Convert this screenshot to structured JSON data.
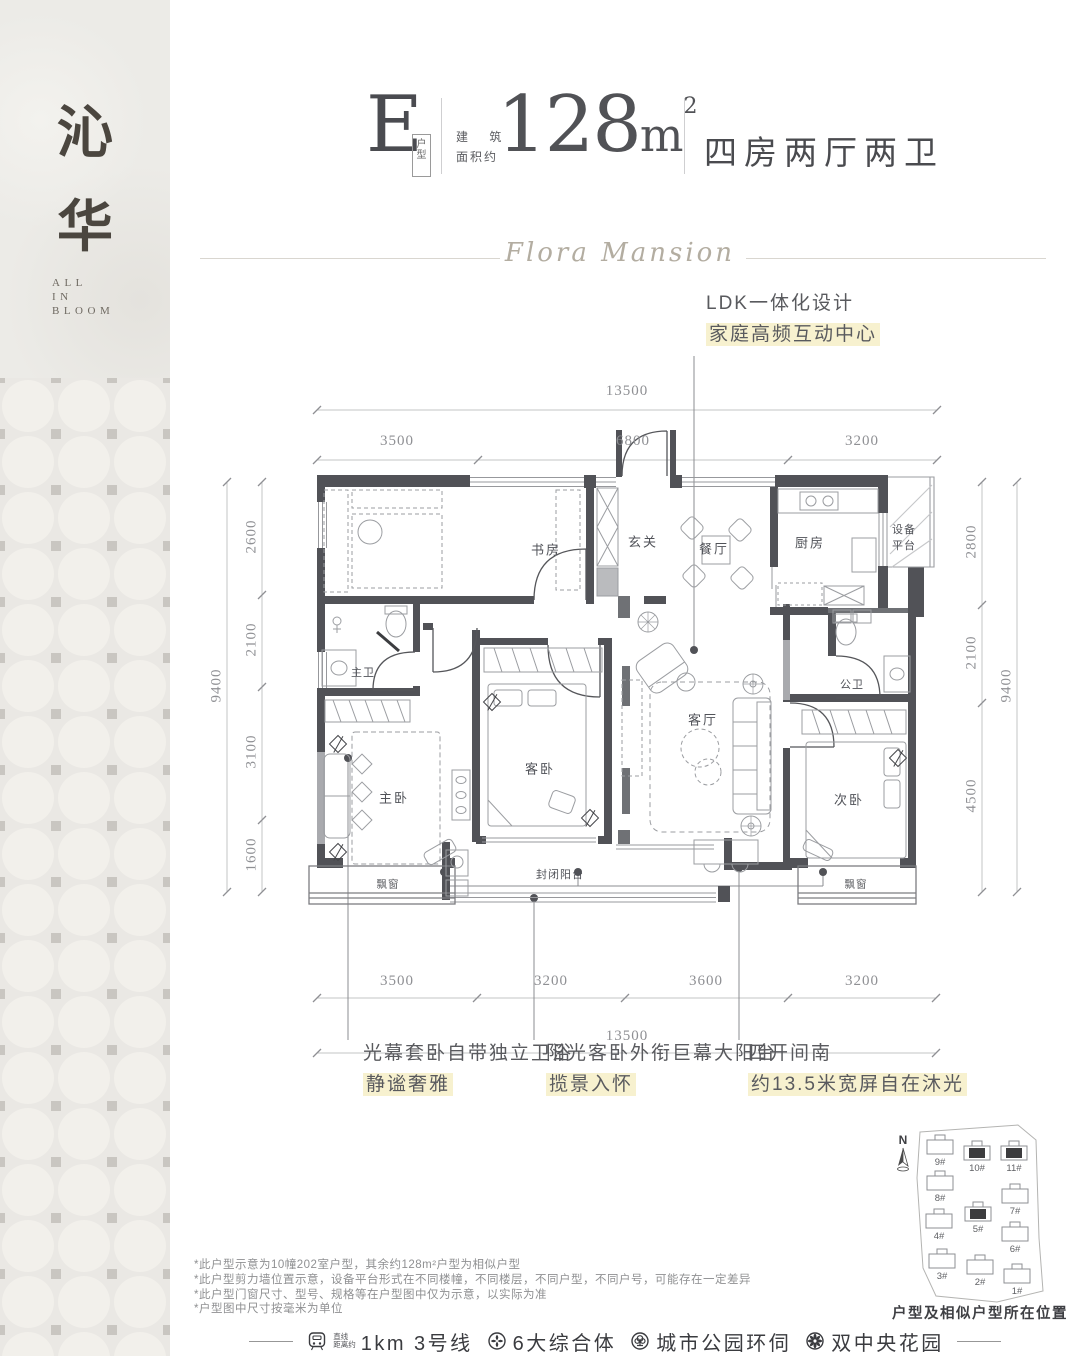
{
  "sidebar": {
    "brand_char_1": "沁",
    "brand_char_2": "华",
    "tagline_line_1": "ALL",
    "tagline_line_2": "IN",
    "tagline_line_3": "BLOOM"
  },
  "header": {
    "plan_letter": "E",
    "plan_letter_tag": "户型",
    "area_label_line_1": "建 筑",
    "area_label_line_2": "面积约",
    "area_value": "128",
    "area_unit": "m",
    "area_exponent": "2",
    "layout_summary": "四房两厅两卫",
    "script_title": "Flora Mansion"
  },
  "callouts": {
    "ldk_line_1": "LDK一体化设计",
    "ldk_line_2": "家庭高频互动中心",
    "master_line_1": "光幕套卧自带独立卫浴",
    "master_line_2": "静谧奢雅",
    "balcony_line_1": "阳光客卧外衔巨幕大阳台",
    "balcony_line_2": "揽景入怀",
    "south_line_1": "四开间南",
    "south_line_2": "约13.5米宽屏自在沐光"
  },
  "dimensions": {
    "top_total": "13500",
    "top_segments": [
      "3500",
      "6800",
      "3200"
    ],
    "bottom_segments": [
      "3500",
      "3200",
      "3600",
      "3200"
    ],
    "bottom_total": "13500",
    "left_total": "9400",
    "left_segments": [
      "2600",
      "2100",
      "3100",
      "1600"
    ],
    "right_total": "9400",
    "right_segments": [
      "2800",
      "2100",
      "4500"
    ]
  },
  "rooms": {
    "study": "书房",
    "foyer": "玄关",
    "dining": "餐厅",
    "kitchen": "厨房",
    "equipment_line_1": "设备",
    "equipment_line_2": "平台",
    "master_bath": "主卫",
    "guest_bath": "公卫",
    "guest_bed": "客卧",
    "living": "客厅",
    "master_bed": "主卧",
    "second_bed": "次卧",
    "balcony": "封闭阳台",
    "bay_window_left": "飘窗",
    "bay_window_right": "飘窗"
  },
  "notes": [
    "*此户型示意为10幢202室户型，其余约128m²户型为相似户型",
    "*此户型剪力墙位置示意，设备平台形式在不同楼幢，不同楼层，不同户型，不同户号，可能存在一定差异",
    "*此户型门窗尺寸、型号、规格等在户型图中仅为示意，以实际为准",
    "*户型图中尺寸按毫米为单位"
  ],
  "site_plan": {
    "compass_label": "N",
    "caption": "户型及相似户型所在位置",
    "buildings": [
      {
        "label": "9#",
        "highlighted": false
      },
      {
        "label": "10#",
        "highlighted": true
      },
      {
        "label": "11#",
        "highlighted": true
      },
      {
        "label": "8#",
        "highlighted": false
      },
      {
        "label": "7#",
        "highlighted": false
      },
      {
        "label": "4#",
        "highlighted": false
      },
      {
        "label": "5#",
        "highlighted": true
      },
      {
        "label": "6#",
        "highlighted": false
      },
      {
        "label": "3#",
        "highlighted": false
      },
      {
        "label": "2#",
        "highlighted": false
      },
      {
        "label": "1#",
        "highlighted": false
      }
    ]
  },
  "footer": {
    "metro_prefix_line_1": "直线",
    "metro_prefix_line_2": "距离约",
    "items": [
      {
        "label": "1km 3号线"
      },
      {
        "label": "6大综合体"
      },
      {
        "label": "城市公园环伺"
      },
      {
        "label": "双中央花园"
      }
    ]
  },
  "colors": {
    "accent_highlight": "#f7f1cf",
    "wall": "#515257",
    "brand_text": "#4b463f"
  }
}
